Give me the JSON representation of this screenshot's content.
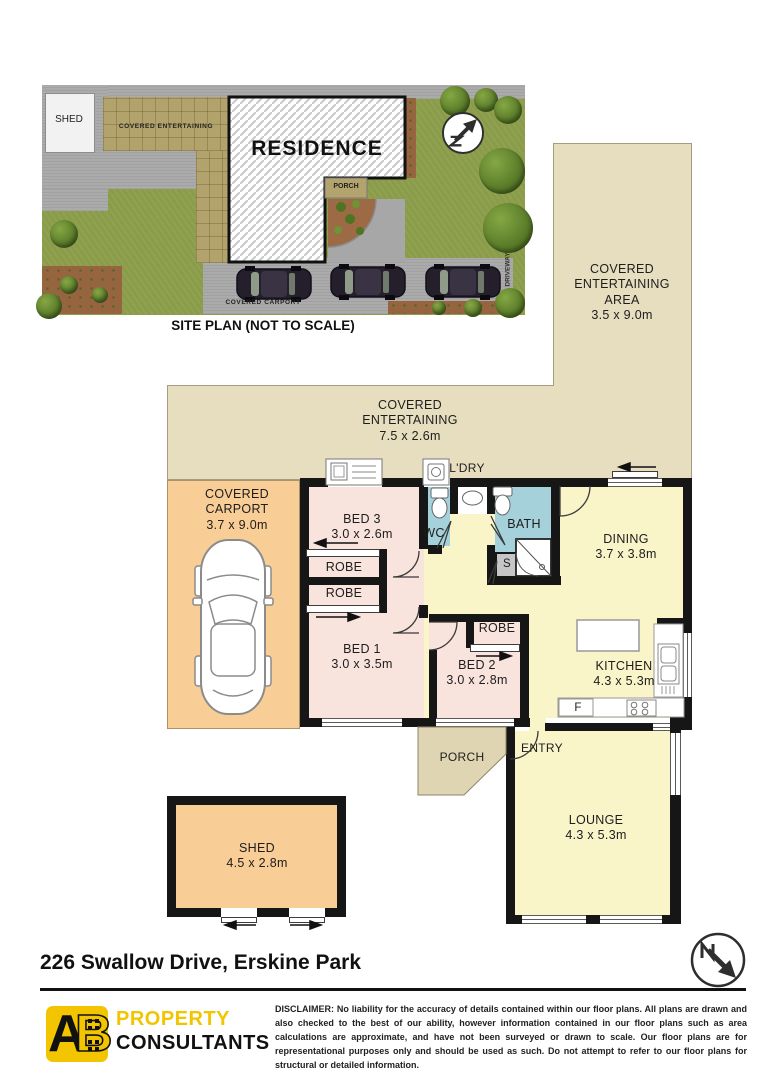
{
  "site_plan": {
    "caption": "SITE PLAN (NOT TO SCALE)",
    "shed": "SHED",
    "covered_entertaining": "COVERED ENTERTAINING",
    "residence": "RESIDENCE",
    "porch": "PORCH",
    "covered_carport": "COVERED CARPORT",
    "driveway": "DRIVEWAY"
  },
  "floor_plan": {
    "rooms": {
      "ce_area": {
        "name": "COVERED ENTERTAINING AREA",
        "dims": "3.5 x 9.0m"
      },
      "ce_mid": {
        "name": "COVERED ENTERTAINING",
        "dims": "7.5 x 2.6m"
      },
      "carport": {
        "name": "COVERED CARPORT",
        "dims": "3.7 x 9.0m"
      },
      "bed3": {
        "name": "BED 3",
        "dims": "3.0 x 2.6m"
      },
      "bed1": {
        "name": "BED 1",
        "dims": "3.0 x 3.5m"
      },
      "bed2": {
        "name": "BED 2",
        "dims": "3.0 x 2.8m"
      },
      "robe_top": {
        "name": "ROBE"
      },
      "robe_bottom": {
        "name": "ROBE"
      },
      "robe_bed2": {
        "name": "ROBE"
      },
      "wc": {
        "name": "WC"
      },
      "bath": {
        "name": "BATH"
      },
      "store": {
        "name": "S"
      },
      "laundry": {
        "name": "L'DRY"
      },
      "dining": {
        "name": "DINING",
        "dims": "3.7 x 3.8m"
      },
      "kitchen": {
        "name": "KITCHEN",
        "dims": "4.3 x 5.3m"
      },
      "fridge": {
        "name": "F"
      },
      "porch": {
        "name": "PORCH"
      },
      "entry": {
        "name": "ENTRY"
      },
      "lounge": {
        "name": "LOUNGE",
        "dims": "4.3 x 5.3m"
      },
      "shed": {
        "name": "SHED",
        "dims": "4.5 x 2.8m"
      }
    }
  },
  "footer": {
    "address": "226 Swallow Drive, Erskine Park",
    "logo": {
      "mark_a": "A",
      "mark_b": "B",
      "line1": "PROPERTY",
      "line2": "CONSULTANTS"
    },
    "disclaimer": "DISCLAIMER: No liability for the accuracy of details contained within our floor plans. All plans are drawn and also checked to the best of our ability, however information contained in our floor plans such as area calculations are approximate, and have not been surveyed or drawn to scale. Our floor plans are for representational purposes only and should be used as such. Do not attempt to refer to our floor plans for structural or detailed information."
  },
  "colors": {
    "covered_area_tan": "#E7DDBF",
    "porch_tan": "#E0D5B2",
    "carport_orange": "#F9CD96",
    "bedroom_pink": "#F8E3DD",
    "living_yellow": "#FAF4C9",
    "wet_blue": "#A5D1DB",
    "store_grey": "#C6C6C6",
    "wall_black": "#161616",
    "grass_green": "#8A9C49",
    "logo_yellow": "#F2C500"
  }
}
